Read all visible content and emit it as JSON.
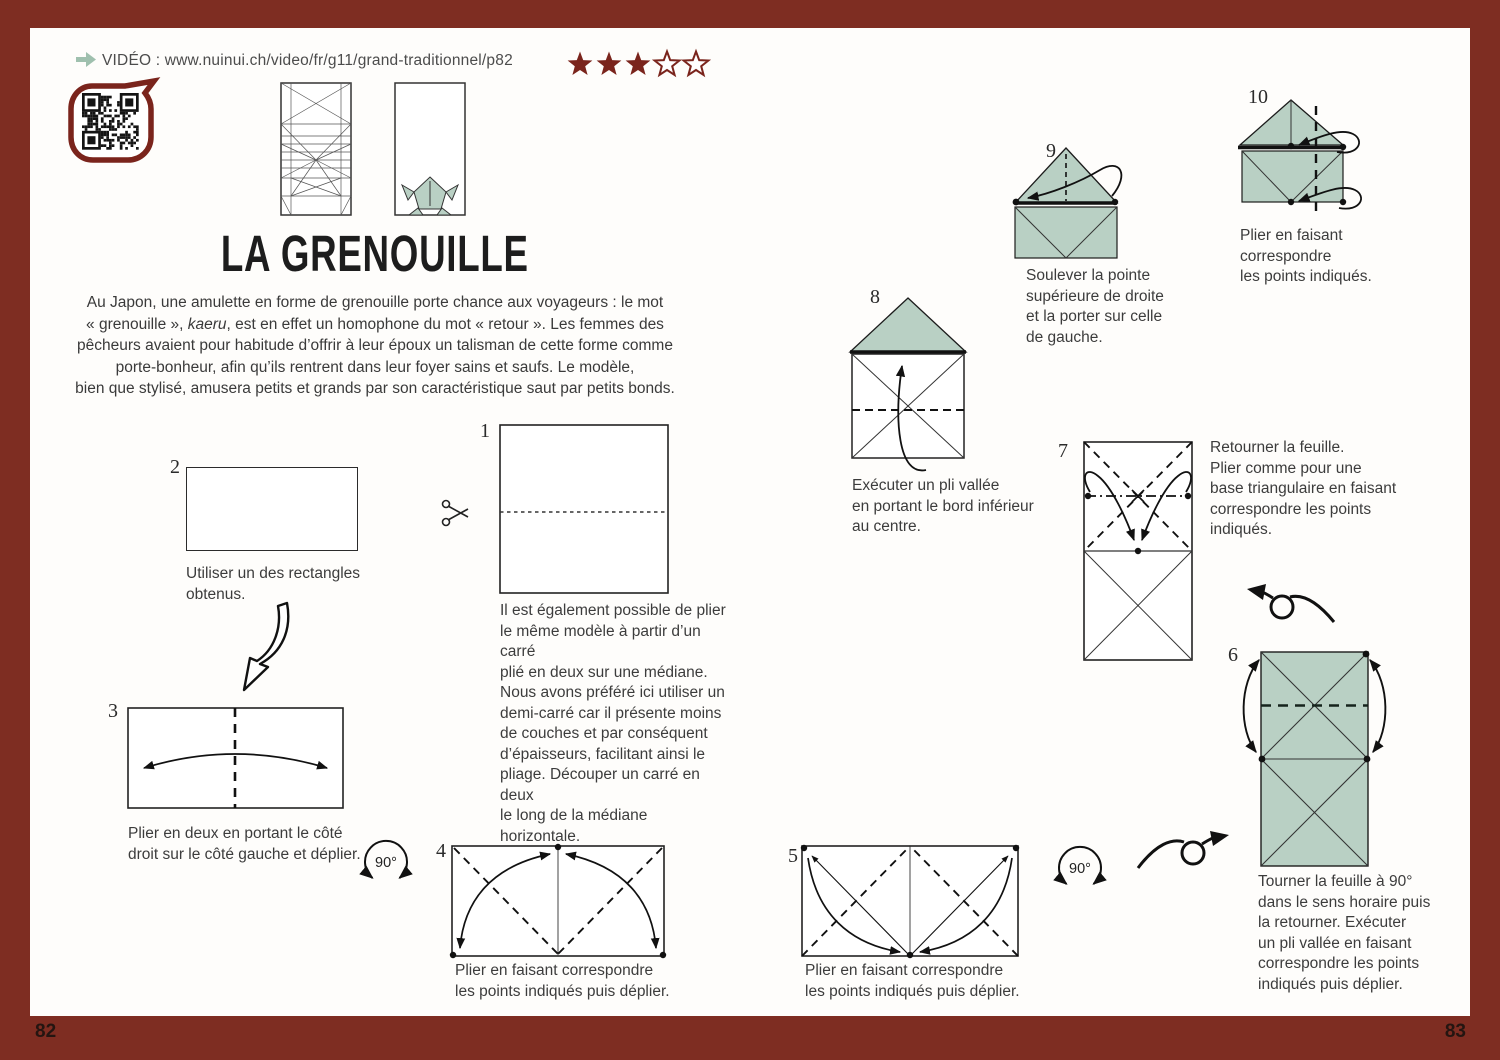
{
  "meta": {
    "left_page_number": "82",
    "right_page_number": "83"
  },
  "header": {
    "video_label": "VIDÉO : www.nuinui.ch/video/fr/g11/grand-traditionnel/p82",
    "rating_filled": 3,
    "rating_total": 5
  },
  "title": "LA GRENOUILLE",
  "intro": {
    "part1": "Au Japon, une amulette en forme de grenouille porte chance aux voyageurs : le mot\n« grenouille », ",
    "italic_word": "kaeru",
    "part2": ", est en effet un homophone du mot « retour ». Les femmes des\npêcheurs avaient pour habitude d’offrir à leur époux un talisman de cette forme comme\nporte-bonheur, afin qu’ils rentrent dans leur foyer sains et saufs. Le modèle,\nbien que stylisé, amusera petits et grands par son caractéristique saut par petits bonds."
  },
  "steps": {
    "s1": {
      "num": "1",
      "caption": "Il est également possible de plier\nle même modèle à partir d’un carré\nplié en deux sur une médiane.\nNous avons préféré ici utiliser un\ndemi-carré car il présente moins\nde couches et par conséquent\nd’épaisseurs, facilitant ainsi le\npliage. Découper un carré en deux\nle long de la médiane horizontale."
    },
    "s2": {
      "num": "2",
      "caption": "Utiliser un des rectangles\nobtenus."
    },
    "s3": {
      "num": "3",
      "caption": "Plier en deux en portant le côté\ndroit sur le côté gauche et déplier."
    },
    "s4": {
      "num": "4",
      "caption": "Plier en faisant correspondre\nles points indiqués puis déplier."
    },
    "s5": {
      "num": "5",
      "caption": "Plier en faisant correspondre\nles points indiqués puis déplier."
    },
    "s6": {
      "num": "6",
      "caption": "Tourner la feuille à 90°\ndans le sens horaire puis\nla retourner. Exécuter\nun pli vallée en faisant\ncorrespondre les points\nindiqués puis déplier."
    },
    "s7": {
      "num": "7",
      "caption": "Retourner la feuille.\nPlier comme pour une\nbase triangulaire en faisant\ncorrespondre les points\nindiqués."
    },
    "s8": {
      "num": "8",
      "caption": "Exécuter un pli vallée\nen portant le bord inférieur\nau centre."
    },
    "s9": {
      "num": "9",
      "caption": "Soulever la pointe\nsupérieure de droite\net la porter sur celle\nde gauche."
    },
    "s10": {
      "num": "10",
      "caption": "Plier en faisant\ncorrespondre\nles points indiqués."
    }
  },
  "symbols": {
    "rotate_a": "90°",
    "rotate_b": "90°"
  },
  "colors": {
    "frame_red": "#7e2d22",
    "accent_red": "#7a241c",
    "paper_green": "#b9d0c4",
    "video_arrow_green": "#9fc0ae",
    "line_dark": "#1c1c1c"
  }
}
